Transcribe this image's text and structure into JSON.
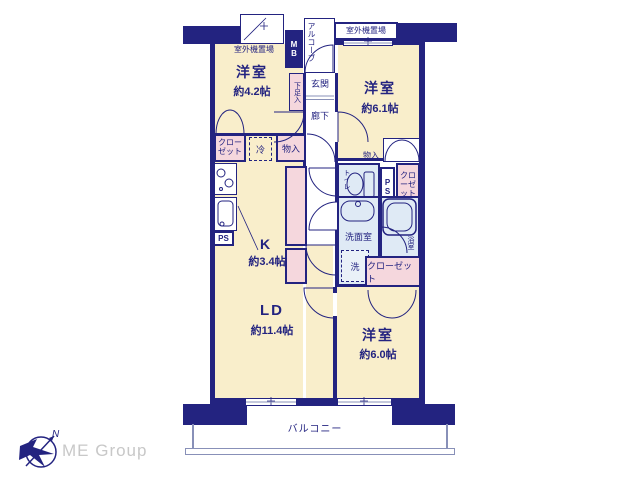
{
  "floorplan": {
    "rooms": {
      "west42": {
        "name": "洋室",
        "size": "約4.2帖"
      },
      "west61": {
        "name": "洋室",
        "size": "約6.1帖"
      },
      "west60": {
        "name": "洋室",
        "size": "約6.0帖"
      },
      "ld": {
        "name": "LD",
        "size": "約11.4帖"
      },
      "kitchen": {
        "name": "K",
        "size": "約3.4帖"
      }
    },
    "labels": {
      "outdoor_unit_left": "室外機置場",
      "outdoor_unit_right": "室外機置場",
      "alcove": "アルコーブ",
      "meter_box": "MB",
      "shoe_cabinet": "下足入",
      "entrance": "玄関",
      "hallway": "廊下",
      "closet_west42": "クローゼット",
      "fridge": "冷",
      "storage_kitchen": "物入",
      "storage_west61": "物入",
      "toilet": "トイレ",
      "pipe_space_left": "PS",
      "pipe_space_right": "PS",
      "closet_west61": "クローゼット",
      "washroom": "洗面室",
      "bathroom": "浴室",
      "washer": "洗",
      "closet_west60": "クローゼット",
      "balcony": "バルコニー"
    },
    "icons": [
      "compass-icon",
      "stove-icon",
      "kitchen-sink-icon",
      "toilet-icon",
      "washbasin-icon",
      "bathtub-icon",
      "door-arc",
      "window-mark"
    ],
    "colors": {
      "wall": "#232380",
      "room_fill": "#f9eecb",
      "closet_fill": "#f5d7dd",
      "wet_area_fill": "#dfeaf5",
      "thin_line": "#8890b8",
      "logo_text": "#c8c8c8"
    },
    "logo": {
      "company": "ME Group",
      "compass_north": "N"
    }
  }
}
